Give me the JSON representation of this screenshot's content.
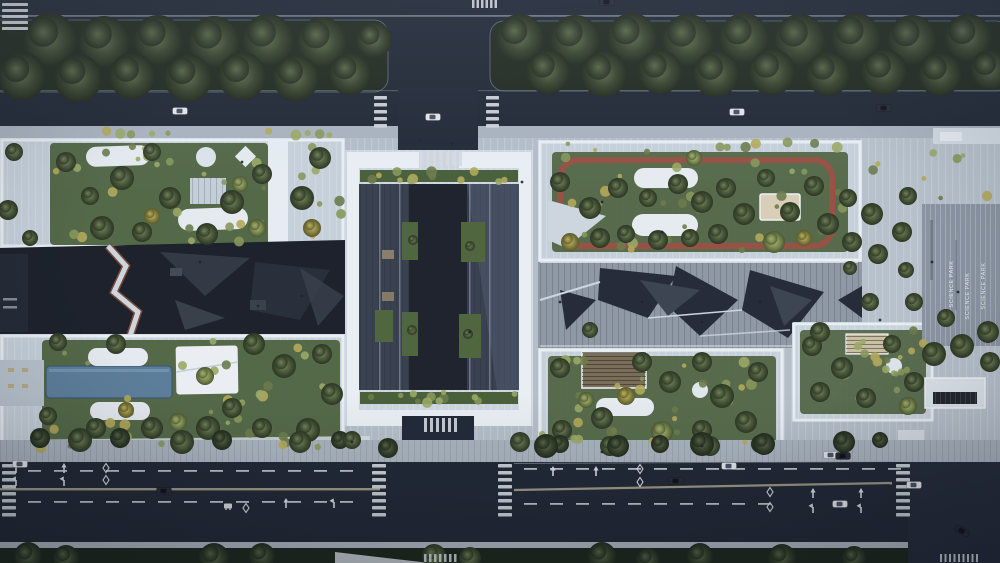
{
  "meta": {
    "description": "Aerial rendering of a science park campus with rooftop gardens, roads and plazas"
  },
  "pavement_text": {
    "label": "SCIENCE PARK"
  },
  "palette": {
    "road": "#222936",
    "intersection": "#252c3b",
    "grass": "#222c21",
    "sidewalk": "#a9b3be",
    "plate": "#b4bec9",
    "roof": "#c6d0da",
    "parapet": "#e9eef3",
    "garden": "#4a5f3c",
    "canyon": "#1d222c",
    "court": "#3a4252",
    "track_red": "#9c5044",
    "pool_blue": "#5d7e9a",
    "plaza_striped": "#8b95a3",
    "marking_white": "#d5dae0",
    "median_tan": "#b0aa92"
  },
  "scene": {
    "trees": [
      [
        50,
        40,
        27,
        "d"
      ],
      [
        104,
        42,
        26,
        "d"
      ],
      [
        158,
        40,
        25,
        "d"
      ],
      [
        214,
        42,
        26,
        "d"
      ],
      [
        268,
        40,
        26,
        "d"
      ],
      [
        322,
        42,
        25,
        "d"
      ],
      [
        22,
        76,
        24,
        "d"
      ],
      [
        78,
        78,
        24,
        "d"
      ],
      [
        132,
        76,
        23,
        "d"
      ],
      [
        188,
        78,
        24,
        "d"
      ],
      [
        242,
        76,
        24,
        "d"
      ],
      [
        296,
        78,
        23,
        "d"
      ],
      [
        350,
        74,
        21,
        "d"
      ],
      [
        374,
        40,
        18,
        "d"
      ],
      [
        520,
        38,
        24,
        "d"
      ],
      [
        575,
        40,
        25,
        "d"
      ],
      [
        632,
        38,
        25,
        "d"
      ],
      [
        688,
        40,
        26,
        "d"
      ],
      [
        744,
        38,
        25,
        "d"
      ],
      [
        800,
        40,
        26,
        "d"
      ],
      [
        856,
        38,
        25,
        "d"
      ],
      [
        912,
        40,
        25,
        "d"
      ],
      [
        968,
        38,
        24,
        "d"
      ],
      [
        548,
        72,
        22,
        "d"
      ],
      [
        604,
        74,
        23,
        "d"
      ],
      [
        660,
        72,
        22,
        "d"
      ],
      [
        716,
        74,
        23,
        "d"
      ],
      [
        772,
        72,
        23,
        "d"
      ],
      [
        828,
        74,
        22,
        "d"
      ],
      [
        884,
        72,
        23,
        "d"
      ],
      [
        940,
        74,
        22,
        "d"
      ],
      [
        990,
        70,
        20,
        "d"
      ],
      [
        66,
        162,
        10,
        "m"
      ],
      [
        122,
        178,
        12,
        "m"
      ],
      [
        152,
        152,
        9,
        "m"
      ],
      [
        170,
        198,
        11,
        "m"
      ],
      [
        232,
        202,
        12,
        "m"
      ],
      [
        262,
        174,
        10,
        "m"
      ],
      [
        302,
        198,
        12,
        "m"
      ],
      [
        320,
        158,
        11,
        "m"
      ],
      [
        102,
        228,
        12,
        "m"
      ],
      [
        142,
        232,
        10,
        "m"
      ],
      [
        207,
        234,
        11,
        "m"
      ],
      [
        257,
        228,
        9,
        "l"
      ],
      [
        152,
        216,
        8,
        "y"
      ],
      [
        312,
        228,
        9,
        "y"
      ],
      [
        90,
        196,
        9,
        "m"
      ],
      [
        240,
        184,
        8,
        "l"
      ],
      [
        14,
        152,
        9,
        "m"
      ],
      [
        8,
        210,
        10,
        "m"
      ],
      [
        30,
        238,
        8,
        "m"
      ],
      [
        58,
        342,
        9,
        "m"
      ],
      [
        116,
        344,
        10,
        "m"
      ],
      [
        254,
        344,
        11,
        "m"
      ],
      [
        284,
        366,
        12,
        "m"
      ],
      [
        322,
        354,
        10,
        "m"
      ],
      [
        332,
        394,
        11,
        "m"
      ],
      [
        308,
        430,
        12,
        "m"
      ],
      [
        262,
        428,
        10,
        "m"
      ],
      [
        208,
        428,
        12,
        "m"
      ],
      [
        152,
        428,
        11,
        "m"
      ],
      [
        96,
        428,
        10,
        "m"
      ],
      [
        48,
        416,
        9,
        "m"
      ],
      [
        232,
        408,
        10,
        "m"
      ],
      [
        178,
        422,
        9,
        "l"
      ],
      [
        126,
        410,
        8,
        "y"
      ],
      [
        205,
        376,
        9,
        "l"
      ],
      [
        40,
        438,
        10,
        "d"
      ],
      [
        80,
        440,
        12,
        "m"
      ],
      [
        120,
        438,
        10,
        "d"
      ],
      [
        182,
        442,
        12,
        "m"
      ],
      [
        222,
        440,
        10,
        "d"
      ],
      [
        300,
        442,
        11,
        "m"
      ],
      [
        340,
        440,
        9,
        "d"
      ],
      [
        352,
        440,
        9,
        "m"
      ],
      [
        520,
        442,
        10,
        "m"
      ],
      [
        560,
        182,
        10,
        "m"
      ],
      [
        590,
        208,
        11,
        "m"
      ],
      [
        618,
        188,
        10,
        "m"
      ],
      [
        648,
        198,
        9,
        "m"
      ],
      [
        678,
        184,
        10,
        "m"
      ],
      [
        702,
        202,
        11,
        "m"
      ],
      [
        726,
        188,
        10,
        "m"
      ],
      [
        744,
        214,
        11,
        "m"
      ],
      [
        718,
        234,
        10,
        "m"
      ],
      [
        690,
        238,
        9,
        "m"
      ],
      [
        658,
        240,
        10,
        "m"
      ],
      [
        626,
        234,
        9,
        "m"
      ],
      [
        600,
        238,
        10,
        "m"
      ],
      [
        766,
        178,
        9,
        "m"
      ],
      [
        790,
        212,
        10,
        "m"
      ],
      [
        814,
        186,
        10,
        "m"
      ],
      [
        828,
        224,
        11,
        "m"
      ],
      [
        848,
        198,
        9,
        "m"
      ],
      [
        852,
        242,
        10,
        "m"
      ],
      [
        774,
        242,
        11,
        "l"
      ],
      [
        570,
        242,
        9,
        "y"
      ],
      [
        804,
        238,
        8,
        "y"
      ],
      [
        694,
        158,
        8,
        "l"
      ],
      [
        560,
        368,
        10,
        "m"
      ],
      [
        602,
        418,
        11,
        "m"
      ],
      [
        562,
        430,
        10,
        "m"
      ],
      [
        642,
        362,
        10,
        "m"
      ],
      [
        670,
        382,
        11,
        "m"
      ],
      [
        702,
        362,
        10,
        "m"
      ],
      [
        722,
        396,
        12,
        "m"
      ],
      [
        746,
        422,
        11,
        "m"
      ],
      [
        758,
        372,
        10,
        "m"
      ],
      [
        702,
        430,
        10,
        "m"
      ],
      [
        662,
        432,
        11,
        "l"
      ],
      [
        626,
        396,
        9,
        "y"
      ],
      [
        586,
        400,
        8,
        "l"
      ],
      [
        560,
        444,
        9,
        "d"
      ],
      [
        610,
        446,
        10,
        "m"
      ],
      [
        660,
        444,
        9,
        "d"
      ],
      [
        710,
        446,
        10,
        "m"
      ],
      [
        760,
        444,
        9,
        "d"
      ],
      [
        812,
        346,
        10,
        "m"
      ],
      [
        842,
        368,
        11,
        "m"
      ],
      [
        820,
        392,
        10,
        "m"
      ],
      [
        866,
        398,
        10,
        "m"
      ],
      [
        892,
        344,
        9,
        "m"
      ],
      [
        914,
        382,
        10,
        "m"
      ],
      [
        908,
        406,
        9,
        "l"
      ],
      [
        872,
        214,
        11,
        "m"
      ],
      [
        902,
        232,
        10,
        "m"
      ],
      [
        878,
        254,
        10,
        "m"
      ],
      [
        908,
        196,
        9,
        "m"
      ],
      [
        934,
        354,
        12,
        "m"
      ],
      [
        962,
        346,
        12,
        "m"
      ],
      [
        988,
        332,
        11,
        "m"
      ],
      [
        946,
        318,
        9,
        "m"
      ],
      [
        990,
        362,
        10,
        "m"
      ],
      [
        906,
        270,
        8,
        "m"
      ],
      [
        914,
        302,
        9,
        "m"
      ],
      [
        870,
        302,
        9,
        "m"
      ],
      [
        388,
        448,
        10,
        "d"
      ],
      [
        546,
        446,
        12,
        "d"
      ],
      [
        618,
        446,
        11,
        "d"
      ],
      [
        702,
        444,
        12,
        "d"
      ],
      [
        764,
        444,
        11,
        "d"
      ],
      [
        844,
        442,
        11,
        "d"
      ],
      [
        880,
        440,
        8,
        "d"
      ],
      [
        28,
        556,
        14,
        "d"
      ],
      [
        66,
        558,
        13,
        "d"
      ],
      [
        214,
        558,
        15,
        "d"
      ],
      [
        262,
        556,
        13,
        "d"
      ],
      [
        434,
        556,
        12,
        "m"
      ],
      [
        470,
        558,
        11,
        "m"
      ],
      [
        602,
        556,
        14,
        "d"
      ],
      [
        648,
        560,
        12,
        "d"
      ],
      [
        700,
        556,
        13,
        "d"
      ],
      [
        782,
        558,
        14,
        "d"
      ],
      [
        854,
        558,
        12,
        "d"
      ],
      [
        590,
        330,
        8,
        "m"
      ],
      [
        820,
        332,
        10,
        "m"
      ],
      [
        850,
        268,
        7,
        "m"
      ],
      [
        413,
        240,
        5,
        "m"
      ],
      [
        470,
        246,
        5,
        "m"
      ],
      [
        412,
        330,
        5,
        "m"
      ],
      [
        468,
        334,
        5,
        "m"
      ]
    ],
    "garden_patches": [
      {
        "x": 52,
        "y": 144,
        "w": 214,
        "h": 98,
        "n": 26
      },
      {
        "x": 292,
        "y": 146,
        "w": 50,
        "h": 96,
        "n": 8
      },
      {
        "x": 44,
        "y": 338,
        "w": 296,
        "h": 108,
        "n": 30
      },
      {
        "x": 554,
        "y": 154,
        "w": 290,
        "h": 96,
        "n": 30
      },
      {
        "x": 550,
        "y": 356,
        "w": 224,
        "h": 94,
        "n": 24
      },
      {
        "x": 802,
        "y": 330,
        "w": 122,
        "h": 80,
        "n": 14
      },
      {
        "x": 362,
        "y": 170,
        "w": 154,
        "h": 12,
        "n": 12
      },
      {
        "x": 362,
        "y": 392,
        "w": 154,
        "h": 12,
        "n": 12
      },
      {
        "x": 60,
        "y": 128,
        "w": 280,
        "h": 10,
        "n": 10
      },
      {
        "x": 546,
        "y": 142,
        "w": 300,
        "h": 10,
        "n": 10
      },
      {
        "x": 30,
        "y": 428,
        "w": 330,
        "h": 20,
        "n": 12
      },
      {
        "x": 540,
        "y": 430,
        "w": 240,
        "h": 18,
        "n": 10
      },
      {
        "x": 860,
        "y": 140,
        "w": 130,
        "h": 60,
        "n": 8
      },
      {
        "x": 862,
        "y": 350,
        "w": 70,
        "h": 40,
        "n": 6
      }
    ],
    "cars": [
      [
        180,
        111,
        "w",
        0
      ],
      [
        433,
        117,
        "w",
        0
      ],
      [
        737,
        112,
        "w",
        0
      ],
      [
        884,
        108,
        "d",
        0
      ],
      [
        607,
        2,
        "d",
        0
      ],
      [
        20,
        464,
        "w",
        0
      ],
      [
        164,
        491,
        "d",
        0
      ],
      [
        676,
        481,
        "d",
        0
      ],
      [
        729,
        466,
        "w",
        0
      ],
      [
        840,
        504,
        "w",
        0
      ],
      [
        914,
        485,
        "w",
        0
      ],
      [
        962,
        531,
        "d",
        28
      ],
      [
        831,
        455,
        "w",
        0
      ],
      [
        843,
        456,
        "d",
        0
      ]
    ],
    "crosswalks": [
      {
        "x": 2,
        "y": 3,
        "n": 5,
        "w": 26,
        "h": 3,
        "g": 3
      },
      {
        "x": 374,
        "y": 96,
        "n": 5,
        "w": 13,
        "h": 3.5,
        "g": 3.5
      },
      {
        "x": 486,
        "y": 96,
        "n": 5,
        "w": 13,
        "h": 3.5,
        "g": 3.5
      },
      {
        "x": 2,
        "y": 464,
        "n": 8,
        "w": 14,
        "h": 3.5,
        "g": 3.5
      },
      {
        "x": 372,
        "y": 464,
        "n": 8,
        "w": 14,
        "h": 3.5,
        "g": 3.5
      },
      {
        "x": 498,
        "y": 464,
        "n": 8,
        "w": 14,
        "h": 3.5,
        "g": 3.5
      },
      {
        "x": 896,
        "y": 464,
        "n": 8,
        "w": 14,
        "h": 3.5,
        "g": 3.5
      }
    ],
    "zebras": [
      {
        "x": 472,
        "y": 0,
        "n": 6,
        "w": 2.5,
        "h": 8,
        "g": 2
      },
      {
        "x": 420,
        "y": 152,
        "n": 7,
        "w": 3,
        "h": 14,
        "g": 3.5
      },
      {
        "x": 424,
        "y": 418,
        "n": 6,
        "w": 3,
        "h": 14,
        "g": 3
      },
      {
        "x": 424,
        "y": 554,
        "n": 7,
        "w": 2.5,
        "h": 8,
        "g": 2.5
      },
      {
        "x": 940,
        "y": 554,
        "n": 9,
        "w": 2,
        "h": 8,
        "g": 2.5
      }
    ],
    "dash_rows": [
      {
        "x1": 28,
        "x2": 362,
        "y": 470
      },
      {
        "x1": 524,
        "x2": 892,
        "y": 468
      },
      {
        "x1": 28,
        "x2": 362,
        "y": 501
      },
      {
        "x1": 524,
        "x2": 760,
        "y": 503
      }
    ],
    "arrows": [
      {
        "x": 16,
        "y": 468,
        "t": "f"
      },
      {
        "x": 64,
        "y": 468,
        "t": "f"
      },
      {
        "x": 16,
        "y": 481,
        "t": "h"
      },
      {
        "x": 64,
        "y": 481,
        "t": "h"
      },
      {
        "x": 286,
        "y": 503,
        "t": "f"
      },
      {
        "x": 334,
        "y": 503,
        "t": "h"
      },
      {
        "x": 553,
        "y": 471,
        "t": "f"
      },
      {
        "x": 596,
        "y": 471,
        "t": "f"
      },
      {
        "x": 813,
        "y": 493,
        "t": "f"
      },
      {
        "x": 861,
        "y": 493,
        "t": "f"
      },
      {
        "x": 813,
        "y": 508,
        "t": "h"
      },
      {
        "x": 861,
        "y": 508,
        "t": "h"
      }
    ],
    "diamonds": [
      [
        106,
        468
      ],
      [
        106,
        480
      ],
      [
        640,
        469
      ],
      [
        640,
        482
      ],
      [
        770,
        492
      ],
      [
        770,
        507
      ],
      [
        246,
        508
      ]
    ],
    "bus_glyphs": [
      [
        228,
        506
      ]
    ],
    "people": [
      [
        246,
        300
      ],
      [
        258,
        306
      ],
      [
        302,
        296
      ],
      [
        200,
        262
      ],
      [
        430,
        252
      ],
      [
        446,
        302
      ],
      [
        470,
        332
      ],
      [
        560,
        302
      ],
      [
        642,
        302
      ],
      [
        702,
        322
      ],
      [
        760,
        302
      ],
      [
        662,
        232
      ],
      [
        602,
        202
      ],
      [
        242,
        162
      ],
      [
        122,
        252
      ],
      [
        522,
        182
      ],
      [
        352,
        442
      ],
      [
        602,
        452
      ],
      [
        702,
        446
      ],
      [
        958,
        292
      ],
      [
        932,
        262
      ],
      [
        880,
        320
      ],
      [
        420,
        140
      ],
      [
        452,
        144
      ]
    ]
  }
}
